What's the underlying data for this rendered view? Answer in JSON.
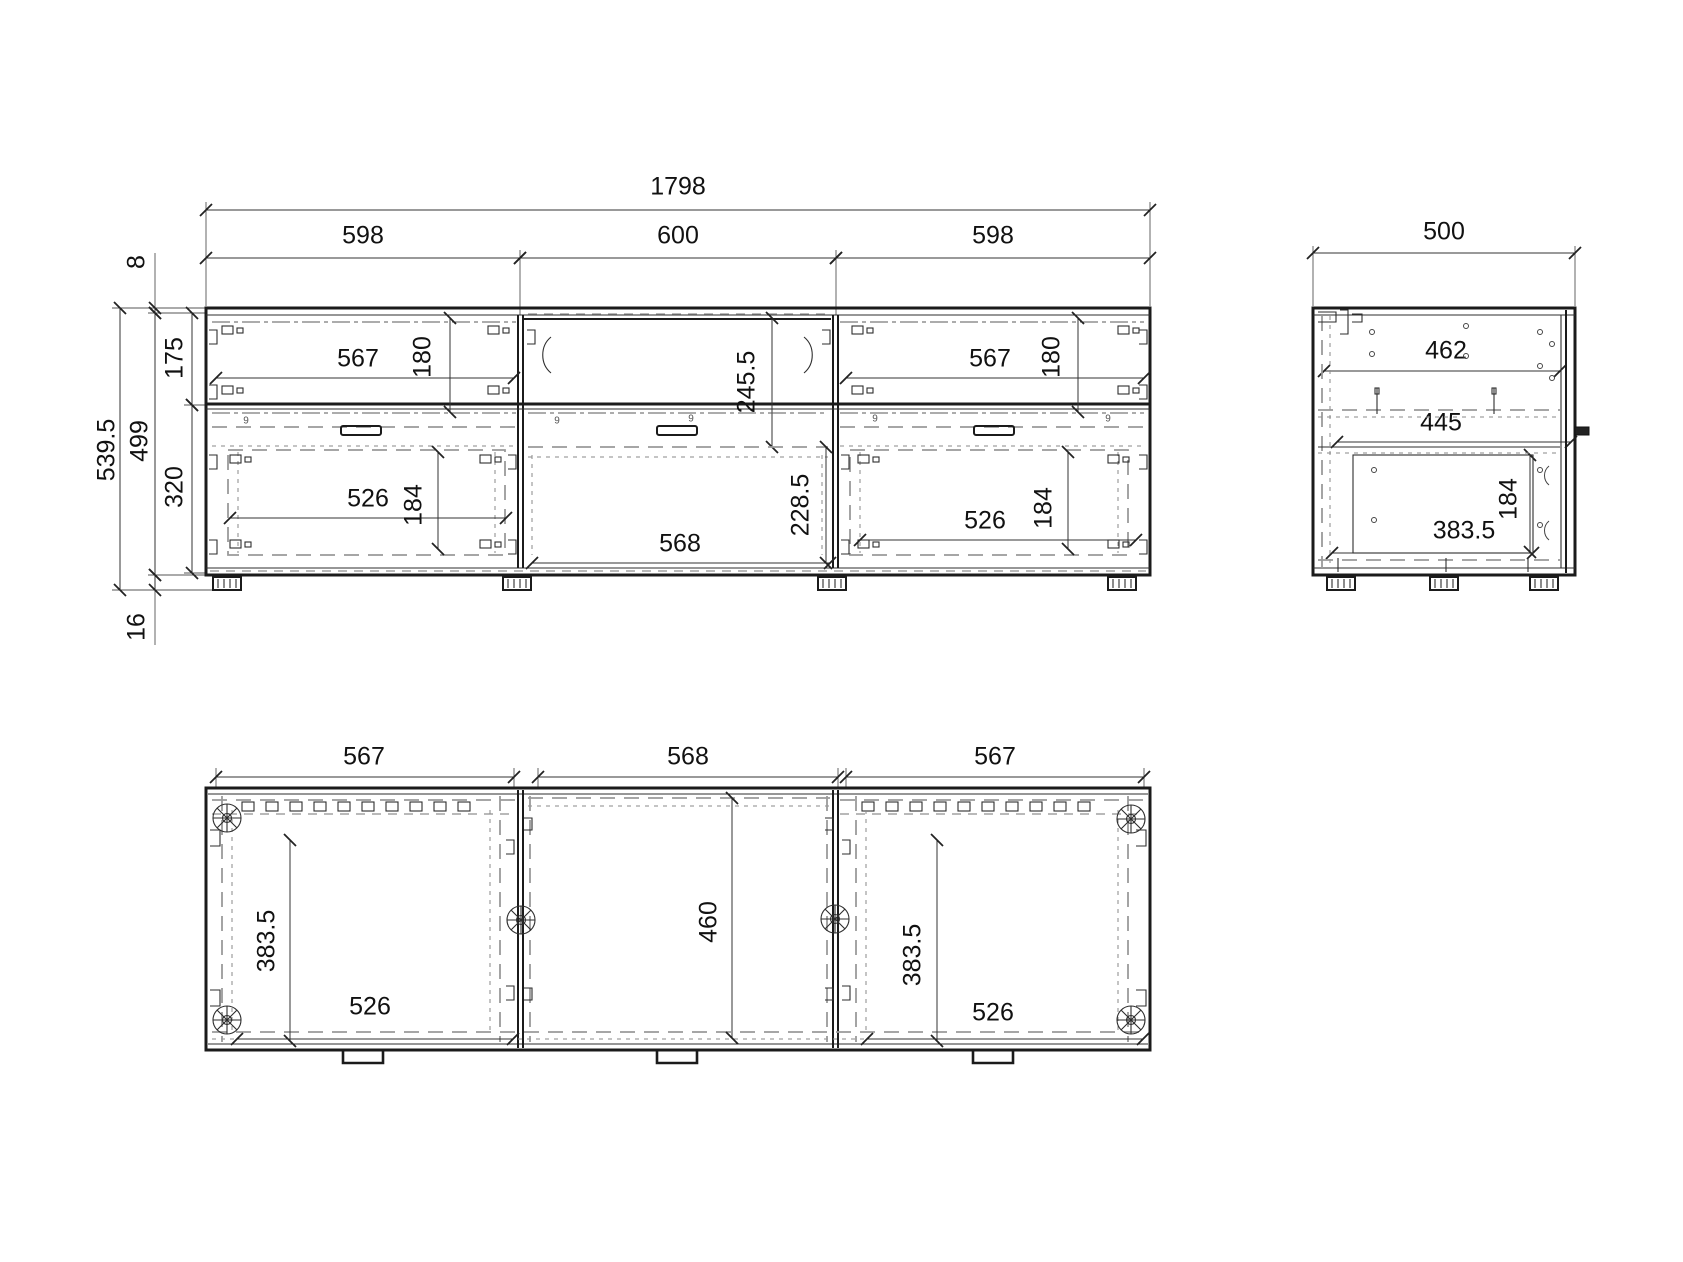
{
  "views": {
    "front": {
      "overall_width": "1798",
      "sections": [
        "598",
        "600",
        "598"
      ],
      "heights": {
        "top_panel": "8",
        "total": "539.5",
        "carcass": "499",
        "upper_row": "175",
        "lower_row": "320",
        "plinth": "16"
      },
      "left": {
        "front_w": "567",
        "front_h": "180",
        "box_w": "526",
        "box_h": "184"
      },
      "middle": {
        "niche_h": "245.5",
        "front_w": "568",
        "front_h": "228.5"
      },
      "right": {
        "front_w": "567",
        "front_h": "180",
        "box_w": "526",
        "box_h": "184"
      },
      "tiny_mark": "9"
    },
    "side": {
      "overall_depth": "500",
      "panel": "462",
      "shelf": "445",
      "box_d": "383.5",
      "box_h": "184"
    },
    "plan": {
      "sections": [
        "567",
        "568",
        "567"
      ],
      "left": {
        "box_d": "383.5",
        "box_w": "526"
      },
      "middle": {
        "inner_w": "460"
      },
      "right": {
        "box_d": "383.5",
        "box_w": "526"
      }
    }
  }
}
